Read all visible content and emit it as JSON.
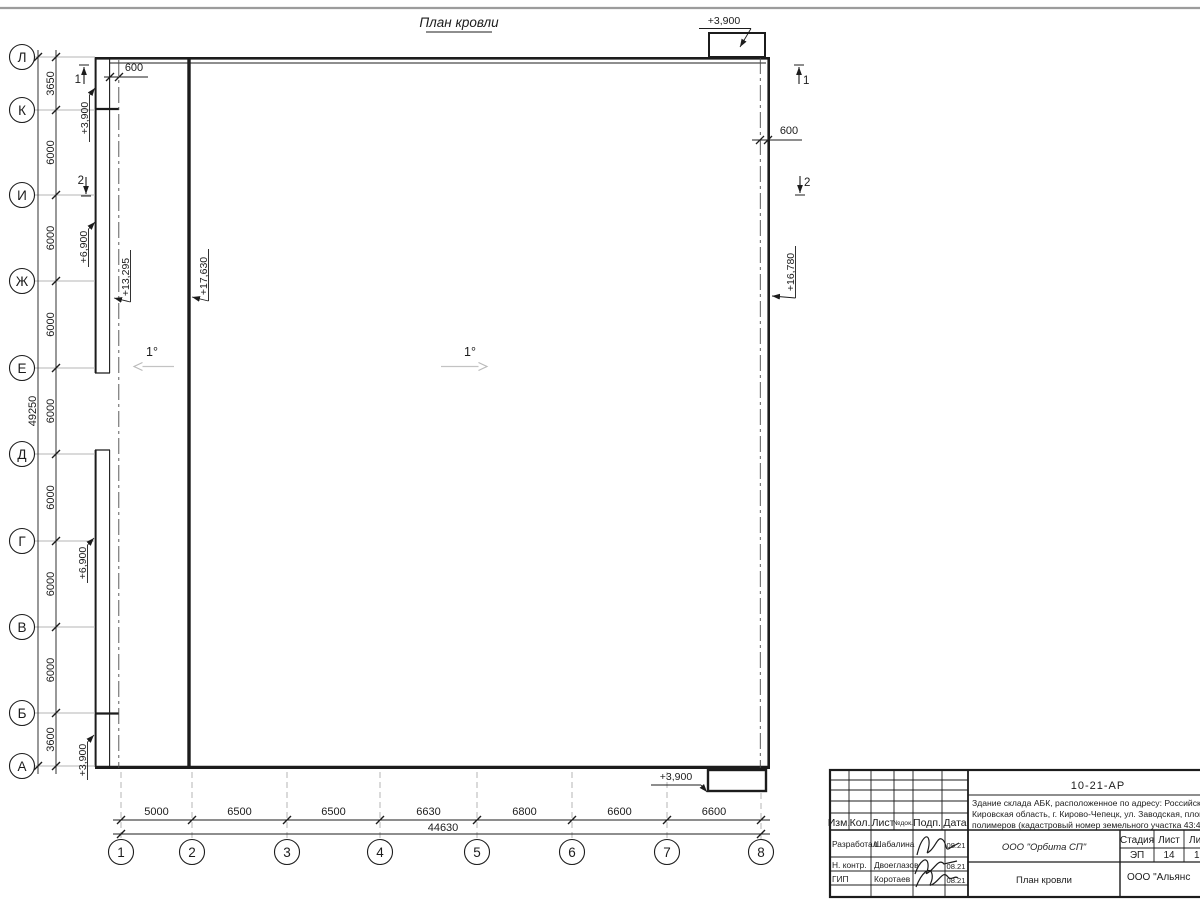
{
  "drawing": {
    "title": "План кровли",
    "slope1": "1°",
    "slope2": "1°",
    "offset_left": "600",
    "offset_right": "600",
    "section1_left": "1",
    "section2_left": "2",
    "section1_right": "1",
    "section2_right": "2",
    "left_axes": [
      "Л",
      "К",
      "И",
      "Ж",
      "Е",
      "Д",
      "Г",
      "В",
      "Б",
      "А"
    ],
    "left_dims": [
      "3650",
      "6000",
      "6000",
      "6000",
      "6000",
      "6000",
      "6000",
      "6000",
      "3600"
    ],
    "left_total": "49250",
    "bottom_axes": [
      "1",
      "2",
      "3",
      "4",
      "5",
      "6",
      "7",
      "8"
    ],
    "bottom_dims": [
      "5000",
      "6500",
      "6500",
      "6630",
      "6800",
      "6600",
      "6600"
    ],
    "bottom_total": "44630",
    "elev": {
      "top_right": "+3,900",
      "left_k": "+3,900",
      "left_izh": "+6,900",
      "left_gv": "+6,900",
      "left_a": "+3,900",
      "low_roof": "+13,295",
      "high_roof": "+17,630",
      "right_roof": "+16,780",
      "bottom_right": "+3,900"
    }
  },
  "titleblock": {
    "doc_number": "10-21-АР",
    "address_line1": "Здание склада АБК, расположенное по адресу: Российская Феде",
    "address_line2": "Кировская область, г. Кирово-Чепецк, ул. Заводская, площадка з",
    "address_line3": "полимеров (кадастровый номер земельного участка 43:42:0000",
    "cols": [
      "Изм.",
      "Кол.",
      "Лист",
      "№док.",
      "Подп.",
      "Дата"
    ],
    "rows": [
      {
        "role": "Разработал",
        "name": "Шабалина",
        "date": "08.21"
      },
      {
        "role": "Н. контр.",
        "name": "Двоеглазов",
        "date": "08.21"
      },
      {
        "role": "ГИП",
        "name": "Коротаев",
        "date": "08.21"
      }
    ],
    "company": "ООО \"Орбита СП\"",
    "sheet_title": "План кровли",
    "stage_label": "Стадия",
    "sheet_label": "Лист",
    "sheets_label": "Листов",
    "stage": "ЭП",
    "sheet_num": "14",
    "sheets_total": "1",
    "bottom_company": "ООО \"Альянс"
  }
}
